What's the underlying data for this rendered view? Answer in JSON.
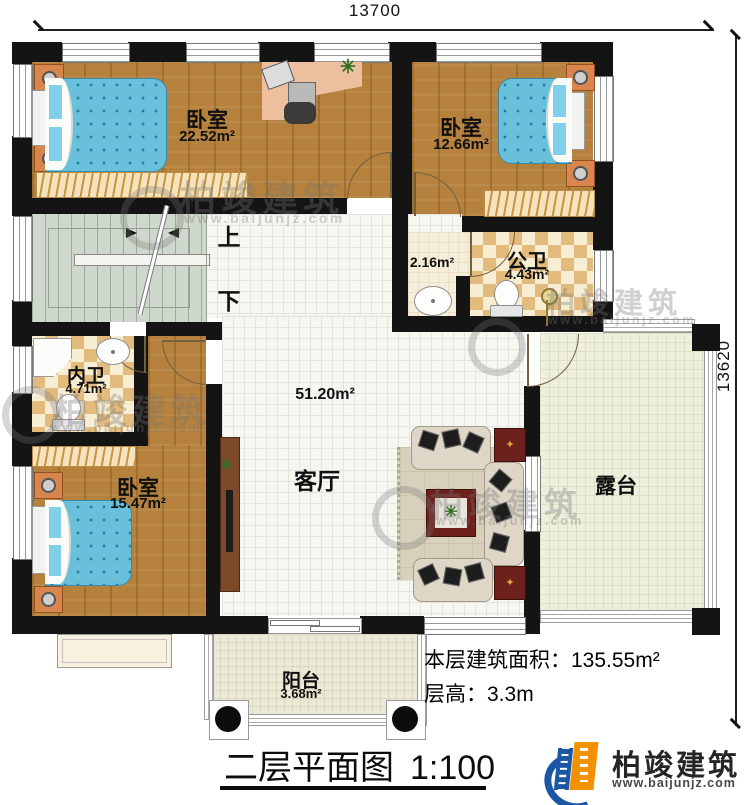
{
  "dimensions": {
    "top": "13700",
    "right": "13620"
  },
  "rooms": {
    "bedroom_top_left": {
      "name": "卧室",
      "area": "22.52m²"
    },
    "bedroom_top_right": {
      "name": "卧室",
      "area": "12.66m²"
    },
    "bedroom_bottom_left": {
      "name": "卧室",
      "area": "15.47m²"
    },
    "living_room": {
      "name": "客厅",
      "area": "51.20m²"
    },
    "public_bathroom": {
      "name": "公卫",
      "area": "4.43m²"
    },
    "wash_area": {
      "area": "2.16m²"
    },
    "private_bathroom": {
      "name": "内卫",
      "area": "4.71m²"
    },
    "terrace": {
      "name": "露台"
    },
    "balcony": {
      "name": "阳台",
      "area": "3.68m²"
    }
  },
  "stairs": {
    "up_label": "上",
    "down_label": "下"
  },
  "notes": {
    "floor_area_label": "本层建筑面积：",
    "floor_area_value": "135.55m²",
    "floor_height_label": "层高：",
    "floor_height_value": "3.3m"
  },
  "title": {
    "name": "二层平面图",
    "scale": "1:100"
  },
  "brand": {
    "name": "柏竣建筑",
    "website": "www.baijunjz.com"
  },
  "watermark": {
    "name": "柏竣建筑",
    "website": "www.baijunjz.com"
  },
  "colors": {
    "wall": "#141414",
    "wood": "#b5813c",
    "bed": "#68c0db",
    "accent_blue": "#1c57a5",
    "accent_orange": "#f29200"
  }
}
